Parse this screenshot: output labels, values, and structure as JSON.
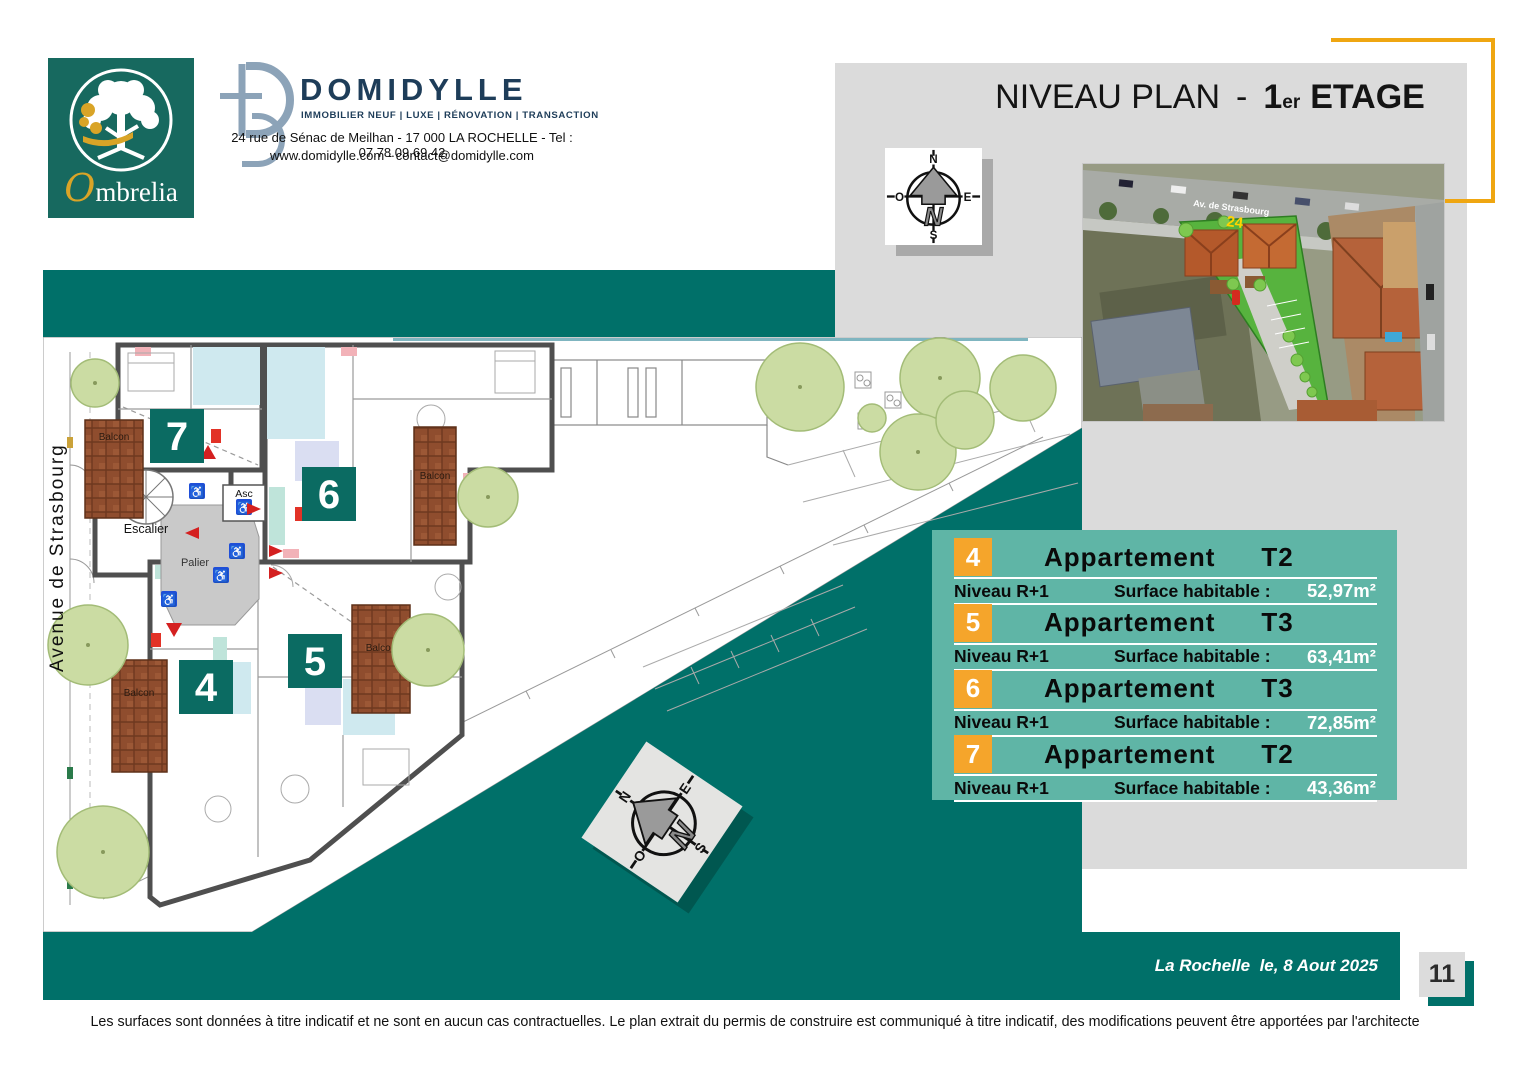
{
  "colors": {
    "teal_dark": "#007069",
    "teal_panel": "#5FB5A6",
    "plan_badge_teal": "#0B6B62",
    "orange_badge": "#F5A52B",
    "orange_bracket": "#EFA611",
    "gray_background": "#DBDBDB",
    "balcony_brown": "#8F4D2E",
    "domidylle_navy": "#1E3D59",
    "ombrelia_teal": "#17695F"
  },
  "branding": {
    "ombrelia": {
      "gold_initial": "O",
      "name_rest": "mbrelia"
    },
    "domidylle": {
      "monogram": "D",
      "name": "DOMIDYLLE",
      "tagline": "IMMOBILIER NEUF | LUXE | RÉNOVATION | TRANSACTION",
      "address": "24 rue de Sénac de Meilhan - 17 000  LA  ROCHELLE - Tel : 07.78.09.69.42",
      "web": "www.domidylle.com - contact@domidylle.com"
    }
  },
  "title": {
    "prefix": "NIVEAU PLAN",
    "dash": "-",
    "level": "1",
    "sup": "er",
    "suffix": "ETAGE"
  },
  "compass": {
    "n": "N",
    "s": "S",
    "e": "E",
    "w": "O",
    "arrow_letter": "N"
  },
  "aerial": {
    "street": "Av. de Strasbourg",
    "number": "24"
  },
  "plan": {
    "street": "Avenue  de  Strasbourg",
    "balcon": "Balcon",
    "escalier": "Escalier",
    "asc": "Asc",
    "palier": "Palier",
    "units": {
      "u7": "7",
      "u6": "6",
      "u5": "5",
      "u4": "4"
    }
  },
  "icons": {
    "wheelchair": "♿"
  },
  "apartments": [
    {
      "num": "4",
      "name": "Appartement",
      "type": "T2",
      "niveau": "Niveau R+1",
      "surface_label": "Surface habitable :",
      "surface": "52,97m²"
    },
    {
      "num": "5",
      "name": "Appartement",
      "type": "T3",
      "niveau": "Niveau R+1",
      "surface_label": "Surface habitable :",
      "surface": "63,41m²"
    },
    {
      "num": "6",
      "name": "Appartement",
      "type": "T3",
      "niveau": "Niveau R+1",
      "surface_label": "Surface habitable :",
      "surface": "72,85m²"
    },
    {
      "num": "7",
      "name": "Appartement",
      "type": "T2",
      "niveau": "Niveau R+1",
      "surface_label": "Surface habitable :",
      "surface": "43,36m²"
    }
  ],
  "footer": {
    "date": "La Rochelle  le, 8 Aout 2025",
    "page": "11",
    "disclaimer": "Les  surfaces  sont  données à  titre  indicatif et ne sont en  aucun  cas  contractuelles. Le plan extrait  du permis de  construire est  communiqué à  titre indicatif, des  modifications peuvent être apportées par l'architecte"
  }
}
